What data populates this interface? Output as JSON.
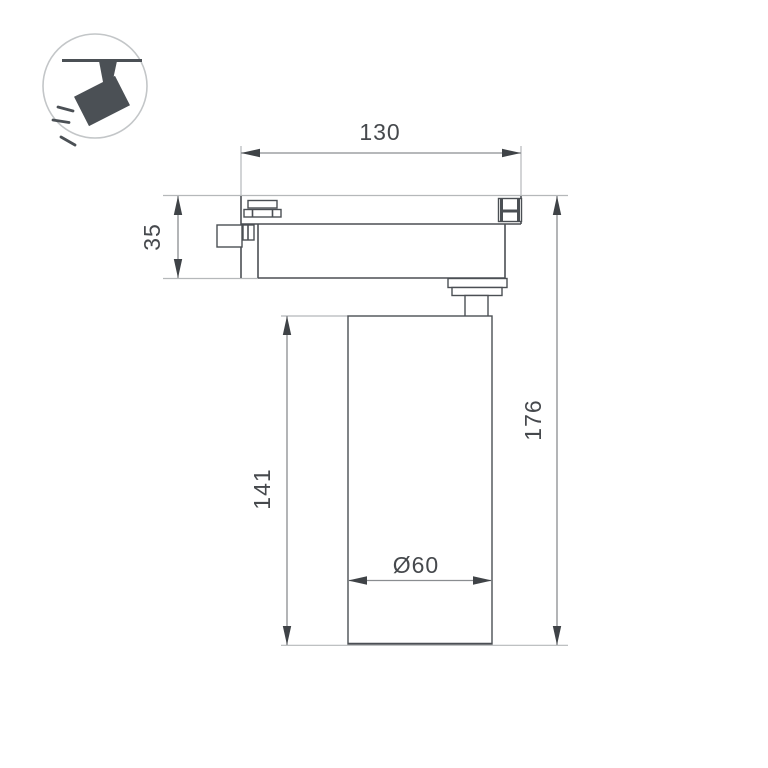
{
  "colors": {
    "background": "#ffffff",
    "object_line": "#4b4f54",
    "dimension_line": "#8a8d90",
    "extension_line": "#b5b8ba",
    "arrow": "#3f4347",
    "text": "#46494d",
    "icon": "#4b5055",
    "icon_circle": "#c3c6c8"
  },
  "dimensions": {
    "track_width": "130",
    "adapter_height": "35",
    "body_height": "141",
    "total_height": "176",
    "diameter": "Ø60"
  }
}
